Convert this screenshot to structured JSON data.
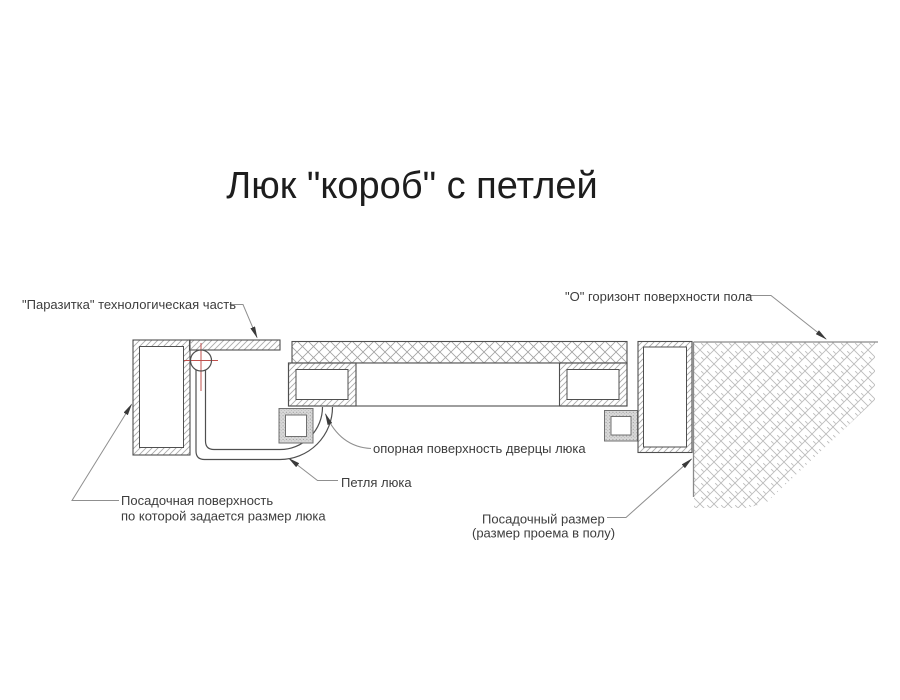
{
  "title": "Люк \"короб\" с петлей",
  "labels": {
    "parasitka": "\"Паразитка\" технологическая часть",
    "floor_level": "\"О\" горизонт поверхности пола",
    "support_surface": "опорная поверхность дверцы люка",
    "hinge": "Петля люка",
    "seating_surface_line1": "Посадочная поверхность",
    "seating_surface_line2": "по которой задается размер люка",
    "seating_size_line1": "Посадочный размер",
    "seating_size_line2": "(размер проема в полу)"
  },
  "colors": {
    "background": "#ffffff",
    "title_text": "#1d1d1d",
    "text": "#3d3d3d",
    "outline": "#4f4f4f",
    "hatch": "#aaaaaa",
    "tile_hatch": "#a3a3a3",
    "concrete_hatch": "#bcbcbc",
    "stipple_bg": "#d8d8d8",
    "stipple_dot": "#8f8f8f",
    "seal_outline": "#707070",
    "leader": "#8f8f8f",
    "arrow": "#3a3a3a",
    "centerline": "#c0504d",
    "floor_line": "#8a8a8a"
  }
}
